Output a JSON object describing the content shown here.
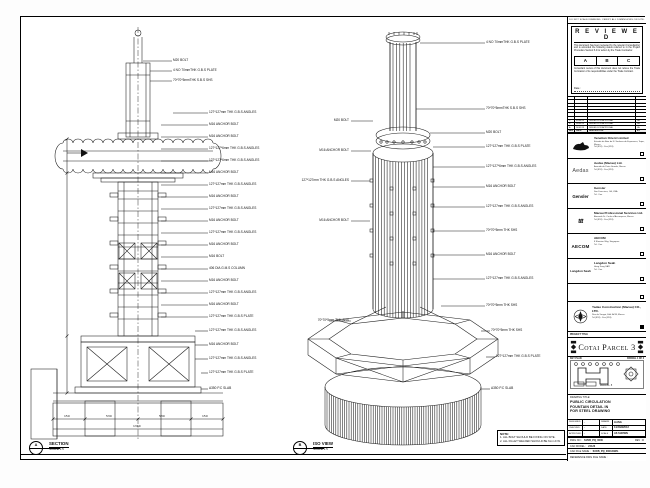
{
  "sheet": {
    "disclaimer": "DO NOT SCALE DRAWING. VERIFY ALL DIMENSIONS ON SITE."
  },
  "stamp": {
    "title": "R E V I E W E D",
    "para1": "This document has been reviewed by the relevant Consultant(s) and is accorded the following status referred to in the Project Procedure Section 5.4 for action by the Trade Contractor.",
    "statuses": [
      "A",
      "B",
      "C"
    ],
    "para2": "Consultant review of this document does not relieve the Trade Contractor of its responsibilities under the Trade Contract.",
    "date_label": "Date :"
  },
  "revision_table": {
    "headers": [
      "REV",
      "DATE",
      "DESCRIPTION",
      "BY"
    ],
    "rows": [
      {
        "rev": "C",
        "date": "05/04/13",
        "description": "ISSUED FOR APPROVAL",
        "by": "LA"
      },
      {
        "rev": "B",
        "date": "28/03/13",
        "description": "ISSUED FOR APPROVAL",
        "by": "LA"
      },
      {
        "rev": "A",
        "date": "14/01/13",
        "description": "ISSUED FOR APPROVAL",
        "by": "LA"
      }
    ]
  },
  "companies": [
    {
      "logo_text": "",
      "name": "Venetian Orient Limited",
      "address_lines": [
        "Estrada da Baia de N. Senhora da Esperanca, Taipa, Macau",
        "Tel (853) · Fax (853)"
      ]
    },
    {
      "logo_text": "Aedas",
      "name": "Aedas (Macau) Ltd.",
      "address_lines": [
        "Avenida da Praia Grande, Macau",
        "Tel (853) · Fax (853)"
      ]
    },
    {
      "logo_text": "Gensler",
      "name": "Gensler",
      "address_lines": [
        "San Francisco, CA, USA",
        "Tel · Fax"
      ]
    },
    {
      "logo_text": "ttt",
      "name": "Macau Professional Services Ltd.",
      "address_lines": [
        "Alameda Dr. Carlos d'Assumpcao, Macau",
        "Tel (853) · Fax (853)"
      ]
    },
    {
      "logo_text": "AECOM",
      "name": "AECOM",
      "address_lines": [
        "8 Shenton Way, Singapore",
        "Tel · Fax"
      ]
    },
    {
      "logo_text": "Langdon Seah",
      "name": "Langdon Seah",
      "address_lines": [
        "Hong Kong SAR",
        "Tel · Fax"
      ]
    }
  ],
  "contractor": {
    "name": "Yadao Construction (Macau) CO., LTD.",
    "address_lines": [
      "Rua de Xangai, Edif. ACM, Macau",
      "Tel (853) · Fax (853)"
    ]
  },
  "project": {
    "label": "PROJECT TITLE",
    "name": "Cotai Parcel 3"
  },
  "key_plan": {
    "label": "KEY PLAN",
    "parcel": "PARCEL 1 OF 3",
    "note": "PARCEL 3"
  },
  "drawing_title": {
    "label": "DRAWING TITLE:",
    "lines": [
      "PUBLIC CIRCULATION",
      "FOUNTAIN DETAIL IN",
      "FOR STEEL DRAWING"
    ]
  },
  "credits": {
    "designed_label": "DESIGNED",
    "designed": "-",
    "checked_label": "CHECKED",
    "checked": "-",
    "approved_label": "APPROVED",
    "approved": "-",
    "drawn_label": "DRAWN",
    "drawn": "LIANG",
    "date_label": "DATE",
    "date": "14/JAN/2013",
    "scale_label": "SCALE",
    "scale": "AS SHOWN"
  },
  "doc": {
    "dwg_no_label": "DWG NO :",
    "dwg_no": "S15/B_PQ_0000",
    "rev_label": "REV :",
    "rev": "C",
    "cad_model_label": "CAD MODEL :",
    "cad_model": "24126",
    "cad_file_label": "CAD FILE NAME :",
    "cad_file": "S15/B_PQ_0000.DWG",
    "ref_label": "REFERENCE DWG FILE NAME :"
  },
  "section_marker": {
    "bubble": "A",
    "label": "SECTION",
    "scale": "SCALE 1:5"
  },
  "iso_marker": {
    "bubble": "B",
    "label": "ISO VIEW",
    "scale": "SCALE 1:5"
  },
  "notes": {
    "title": "NOTE:",
    "lines": [
      "1. ALL BOLT SHOULD BE FIXING ON SITE.",
      "2. ALL FILLET WELDED SHOULD BE 6mm F.W."
    ]
  },
  "section_view": {
    "dims": [
      "150",
      "530",
      "530",
      "150",
      "1360"
    ],
    "annotations": [
      "M20 BOLT",
      "4 NO 70mmTHK G.B.S PLATE",
      "70*70*5mmTHK S.B.S SHS",
      "127*127mm THK G.B.S ANGLES",
      "M16 ANCHOR BOLT",
      "M16 ANCHOR BOLT",
      "127*127*6mm THK G.B.S ANGLES",
      "127*127*6mm THK G.B.S ANGLES",
      "M16 ANCHOR BOLT",
      "127*127mm THK G.B.S ANGLES",
      "M16 ANCHOR BOLT",
      "127*127mm THK G.B.S ANGLES",
      "M16 ANCHOR BOLT",
      "127*127mm THK G.B.S ANGLES",
      "M16 ANCHOR BOLT",
      "M16 BOLT",
      "406 DIA G.M.S COLUMN",
      "M16 ANCHOR BOLT",
      "127*127mm THK G.B.S ANGLES",
      "M16 ANCHOR BOLT",
      "127*127mm THK G.B.S PLATE",
      "127*127mm THK G.B.S ANGLES",
      "M16 ANCHOR BOLT",
      "127*127mm THK G.B.S ANGLES",
      "127*127mm THK G.B.S PLATE",
      "A350 P.C SLAB"
    ]
  },
  "iso_view": {
    "annotations_right": [
      "4 NO 70mmTHK G.B.S PLATE",
      "70*70*5mmTHK S.B.S SHS",
      "M20 BOLT",
      "127*127mm THK G.B.S PLATE",
      "127*127*6mm THK G.B.S ANGLES",
      "M16 ANCHOR BOLT",
      "127*127mm THK G.B.S ANGLES",
      "70*70*5mm THK SHS",
      "M16 ANCHOR BOLT",
      "127*127mm THK G.B.S ANGLES",
      "70*70*5mm THK SHS",
      "70*70*5mm THK SHS",
      "127*127mm THK G.B.S PLATE",
      "A350 P.C SLAB"
    ],
    "annotations_left": [
      "M20 BOLT",
      "M16 ANCHOR BOLT",
      "127*127mm THK G.B.S ANGLES",
      "M16 ANCHOR BOLT",
      "70*70*5mm THK SHS"
    ]
  }
}
